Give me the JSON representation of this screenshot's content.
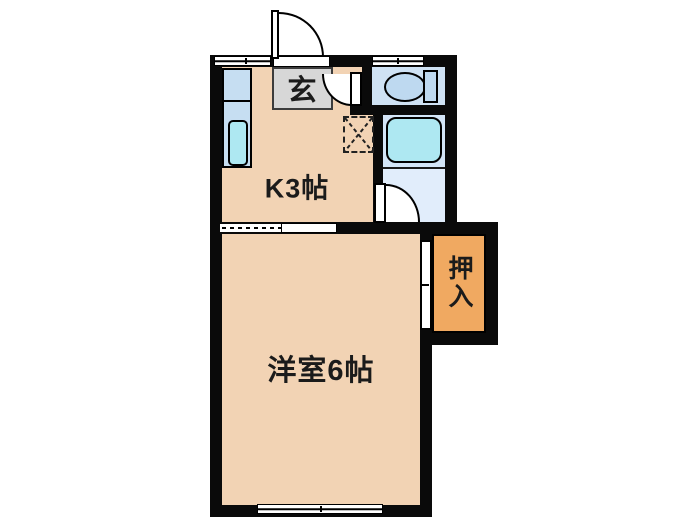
{
  "plan": {
    "rooms": {
      "entrance": {
        "label": "玄"
      },
      "kitchen": {
        "label": "K3帖"
      },
      "western_room": {
        "label": "洋室6帖"
      },
      "closet": {
        "label": "押入"
      }
    },
    "fixtures": [
      "toilet",
      "bathtub",
      "kitchen-sink",
      "refrigerator-space"
    ],
    "colors": {
      "room_fill": "#f2d3b4",
      "wall": "#0a0a0a",
      "entrance_fill": "#d7d7d7",
      "entrance_border": "#3c3c3c",
      "toilet_room_fill": "#cfe2f4",
      "bath_fill": "#d3e5f7",
      "bath_lower_fill": "#e1edfb",
      "tub_fill": "#aee8f2",
      "kitchen_unit_fill": "#c6def2",
      "fixture_fill": "#bed9f0",
      "closet_fill": "#f0a961",
      "label_color": "#1b1b1b"
    }
  }
}
